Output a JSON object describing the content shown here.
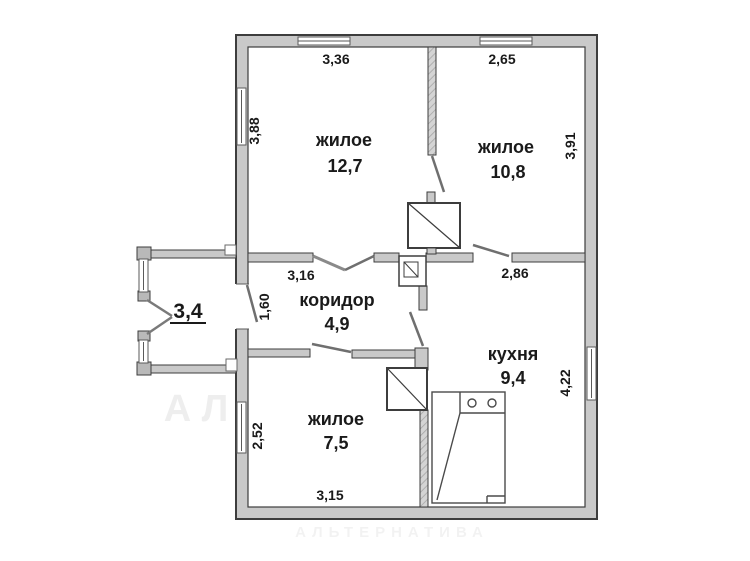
{
  "watermark": {
    "brand": "АЛЬТЕРНАТИВА",
    "site": "a-brest.by"
  },
  "rooms": {
    "living1": {
      "label": "жилое",
      "area": "12,7"
    },
    "living2": {
      "label": "жилое",
      "area": "10,8"
    },
    "corridor": {
      "label": "коридор",
      "area": "4,9"
    },
    "kitchen": {
      "label": "кухня",
      "area": "9,4"
    },
    "living3": {
      "label": "жилое",
      "area": "7,5"
    },
    "porch": {
      "area": "3,4"
    }
  },
  "dimensions": {
    "living1_width": "3,36",
    "living2_width": "2,65",
    "living1_height": "3,88",
    "living2_height": "3,91",
    "corridor_width": "3,16",
    "kitchen_width": "2,86",
    "entry_height": "1,60",
    "kitchen_height": "4,22",
    "living3_height": "2,52",
    "living3_width": "3,15"
  },
  "colors": {
    "wall_fill": "#c9c9c9",
    "outline": "#3d3d3d",
    "text": "#1a1a1a",
    "watermark": "#e7e7e7"
  }
}
